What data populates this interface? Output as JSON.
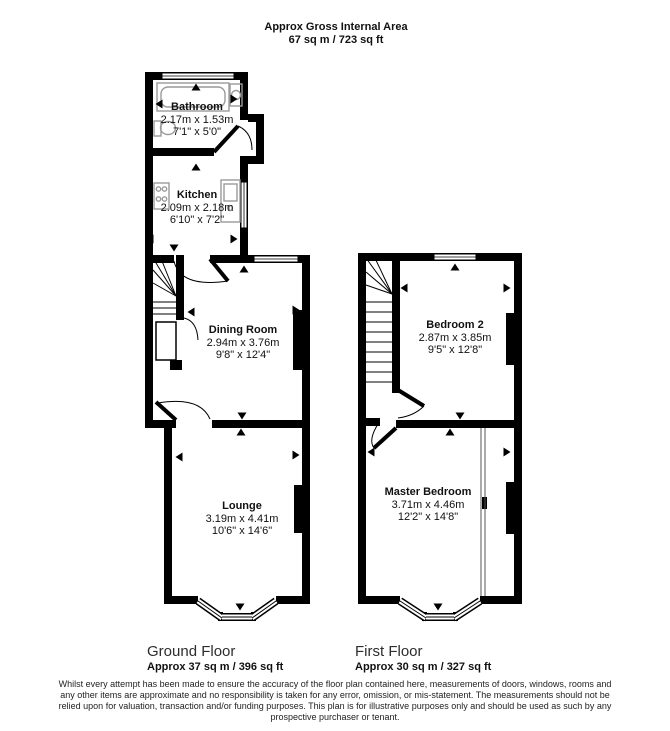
{
  "header": {
    "title": "Approx Gross Internal Area",
    "subtitle": "67 sq m / 723 sq ft"
  },
  "ground_floor": {
    "label": "Ground Floor",
    "area": "Approx 37 sq m / 396 sq ft",
    "rooms": {
      "bathroom": {
        "name": "Bathroom",
        "metric": "2.17m x 1.53m",
        "imperial": "7'1\" x 5'0\""
      },
      "kitchen": {
        "name": "Kitchen",
        "metric": "2.09m x 2.18m",
        "imperial": "6'10\" x 7'2\""
      },
      "dining": {
        "name": "Dining Room",
        "metric": "2.94m x 3.76m",
        "imperial": "9'8\" x 12'4\""
      },
      "lounge": {
        "name": "Lounge",
        "metric": "3.19m x 4.41m",
        "imperial": "10'6\" x 14'6\""
      }
    }
  },
  "first_floor": {
    "label": "First Floor",
    "area": "Approx 30 sq m / 327 sq ft",
    "rooms": {
      "bedroom2": {
        "name": "Bedroom 2",
        "metric": "2.87m x 3.85m",
        "imperial": "9'5\" x 12'8\""
      },
      "master": {
        "name": "Master Bedroom",
        "metric": "3.71m x 4.46m",
        "imperial": "12'2\" x 14'8\""
      }
    }
  },
  "disclaimer": {
    "lines": [
      "Whilst every attempt has been made to ensure the accuracy of the floor plan contained here, measurements of doors, windows, rooms and",
      "any other items are approximate and no responsibility is taken for any error, omission, or mis-statement. The measurements should not be",
      "relied upon for valuation, transaction and/or funding purposes. This plan is for illustrative purposes only and should be used as such by any",
      "prospective purchaser or tenant."
    ]
  },
  "colors": {
    "wall": "#000000",
    "fixture": "#9a9a9a",
    "text": "#111111"
  }
}
